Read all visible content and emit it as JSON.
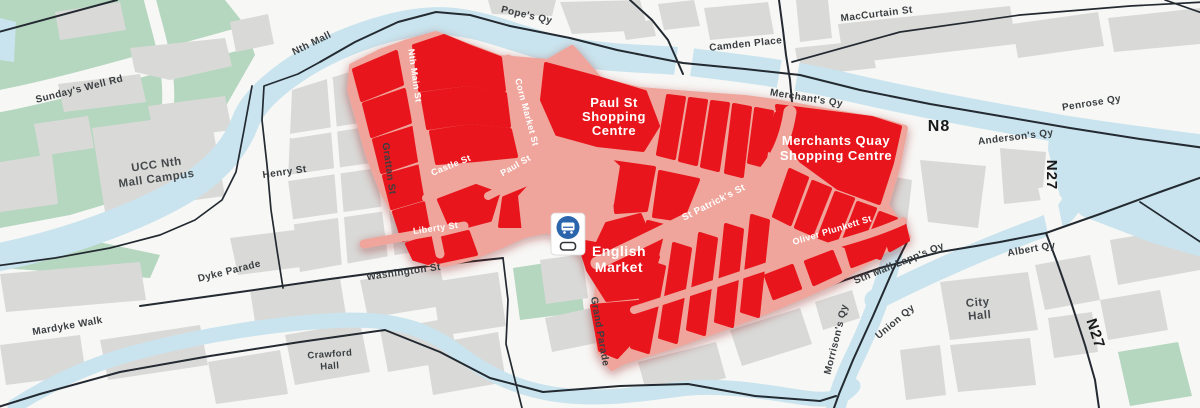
{
  "streets": {
    "sundays_well_rd": "Sunday's Well Rd",
    "nth_mall": "Nth Mall",
    "popes_qy": "Pope's Qy",
    "camden_place": "Camden Place",
    "maccurtain_st": "MacCurtain St",
    "merchants_qy": "Merchant's Qy",
    "penrose_qy": "Penrose Qy",
    "andersons_qy": "Anderson's Qy",
    "albert_qy": "Albert Qy",
    "union_qy": "Union Qy",
    "morrisons_qy": "Morrison's Qy",
    "sth_mall_lapps_qy": "Sth Mall Lapp's Qy",
    "henry_st": "Henry St",
    "grattan_st": "Grattan St",
    "washington_st": "Washington St",
    "dyke_parade": "Dyke Parade",
    "mardyke_walk": "Mardyke Walk",
    "grand_parade": "Grand Parade",
    "nth_main_st": "Nth Main St",
    "corn_market_st": "Corn Market St",
    "castle_st": "Castle St",
    "paul_st": "Paul St",
    "liberty_st": "Liberty St",
    "st_patricks_st": "St Patrick's St",
    "oliver_plunkett_st": "Oliver Plunkett St"
  },
  "places": {
    "ucc_line1": "UCC Nth",
    "ucc_line2": "Mall Campus",
    "crawford_line1": "Crawford",
    "crawford_line2": "Hall",
    "city_hall_line1": "City",
    "city_hall_line2": "Hall"
  },
  "zone_labels": {
    "paul_sc_line1": "Paul St",
    "paul_sc_line2": "Shopping",
    "paul_sc_line3": "Centre",
    "merchants_sc_line1": "Merchants Quay",
    "merchants_sc_line2": "Shopping Centre",
    "english_market_line1": "English",
    "english_market_line2": "Market"
  },
  "route_markers": {
    "n8": "N8",
    "n27_east": "N27",
    "n27_south": "N27"
  },
  "icons": {
    "bus_sign": "bus-lane-sign"
  },
  "colors": {
    "highlight_red": "#e8141c",
    "pedestrian_pink": "#efa59b",
    "river_blue": "#c9e4ee",
    "park_green": "#b5d6bf",
    "building_grey": "#d9dad8",
    "background": "#f7f7f5",
    "road_line": "#232a31",
    "label_dark": "#3a3e41",
    "bus_sign_blue": "#2b66ad"
  }
}
